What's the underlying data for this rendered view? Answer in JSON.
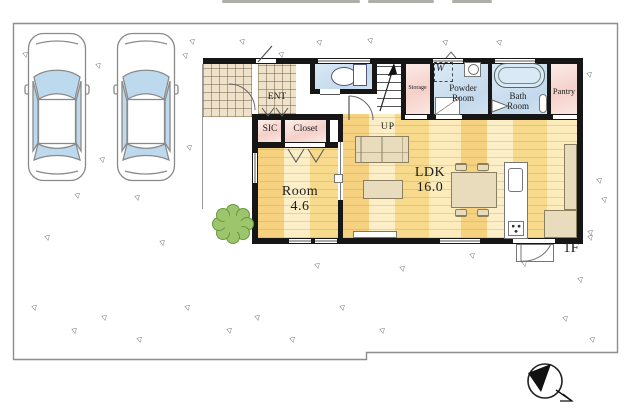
{
  "plan": {
    "floor_label": "1F",
    "labels": {
      "ent": "ENT",
      "sic": "SIC",
      "closet": "Closet",
      "up": "UP",
      "storage": "Storage",
      "washer": "W",
      "powder_room": "Powder Room",
      "bath_room": "Bath Room",
      "pantry": "Pantry",
      "ldk_name": "LDK",
      "ldk_size": "16.0",
      "room_name": "Room",
      "room_size": "4.6"
    }
  },
  "colors": {
    "wall": "#161616",
    "wood_floor": "#f8e3a6",
    "wet_area_floor": "#c9dced",
    "closet_floor": "#f5d0c9",
    "tile_floor": "#efe2cd",
    "furniture": "#e8dcbd",
    "car_glass": "#bdd9ee",
    "tree_green": "#9dc56b",
    "site_border": "#8c8c8c"
  },
  "icons": {
    "compass": "north-arrow-compass",
    "tree": "garden-tree",
    "cars": "parked-car-top-view",
    "grass": "grass-mark"
  }
}
